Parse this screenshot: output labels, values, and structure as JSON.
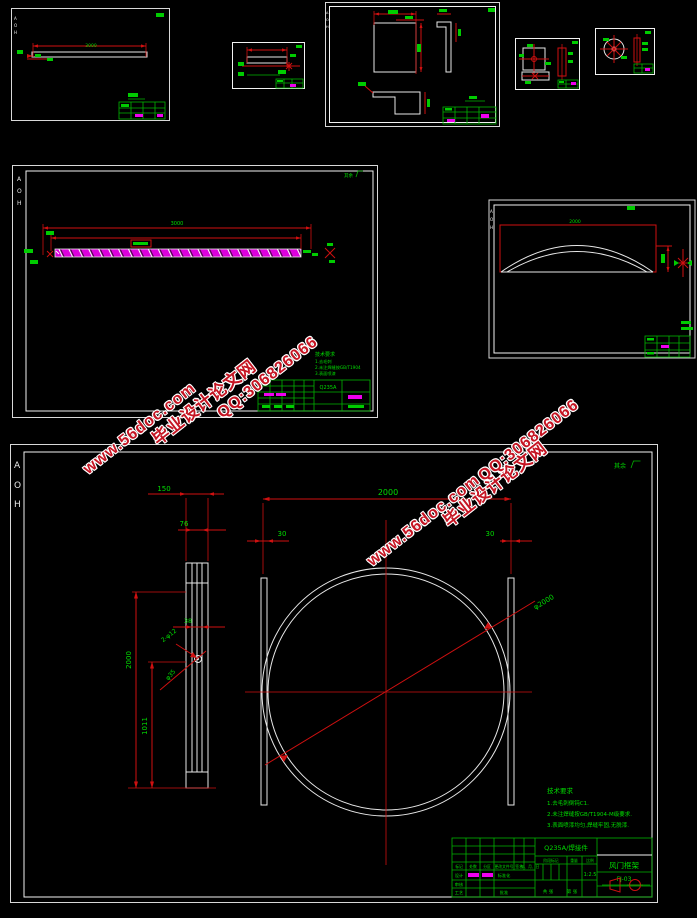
{
  "watermark": {
    "site": "www.56doc.com",
    "name": "毕业设计论文网",
    "qq": "QQ:306826066"
  },
  "zone": {
    "a": "A",
    "o": "O",
    "h": "H"
  },
  "sheet_beam": {
    "dim_total": "3000"
  },
  "sheet_plate": {
    "dim_total": "3000",
    "roughness": "其余",
    "notes": {
      "t": "技术要求",
      "n1": "1.去毛刺",
      "n2": "2.未注焊缝按GB/T1904",
      "n3": "3.表面喷漆"
    },
    "material": "Q235A"
  },
  "sheet_dome": {
    "dim_width": "2000"
  },
  "sheet_door": {
    "dims": {
      "w2000": "2000",
      "d150": "150",
      "d76": "76",
      "d30l": "30",
      "d30r": "30",
      "dia": "φ2000",
      "d38": "38",
      "holes": "2-φ12",
      "d35": "φ35",
      "h2000": "2000",
      "h1011": "1011"
    },
    "roughness": "其余",
    "notes": {
      "t": "技术要求",
      "n1": "1.去毛刺倒钝C1.",
      "n2": "2.未注焊缝按GB/T1904-M级要求.",
      "n3": "3.表面喷漆均匀,焊缝牢固,无脱漆."
    },
    "titleblock": {
      "material": "Q235A/焊接件",
      "name": "风门框架",
      "code": "FJ-03",
      "scale": "1:2.5",
      "h_mark": "标记",
      "h_count": "处数",
      "h_zone": "分区",
      "h_doc": "更改文件号",
      "h_sign": "签名",
      "h_date": "年、月、日",
      "design": "设计",
      "check": "审核",
      "craft": "工艺",
      "approve": "批准",
      "std": "标准化",
      "stage": "阶段标记",
      "weight": "重量",
      "scale_label": "比例",
      "total": "共 张",
      "page": "第 张"
    }
  }
}
